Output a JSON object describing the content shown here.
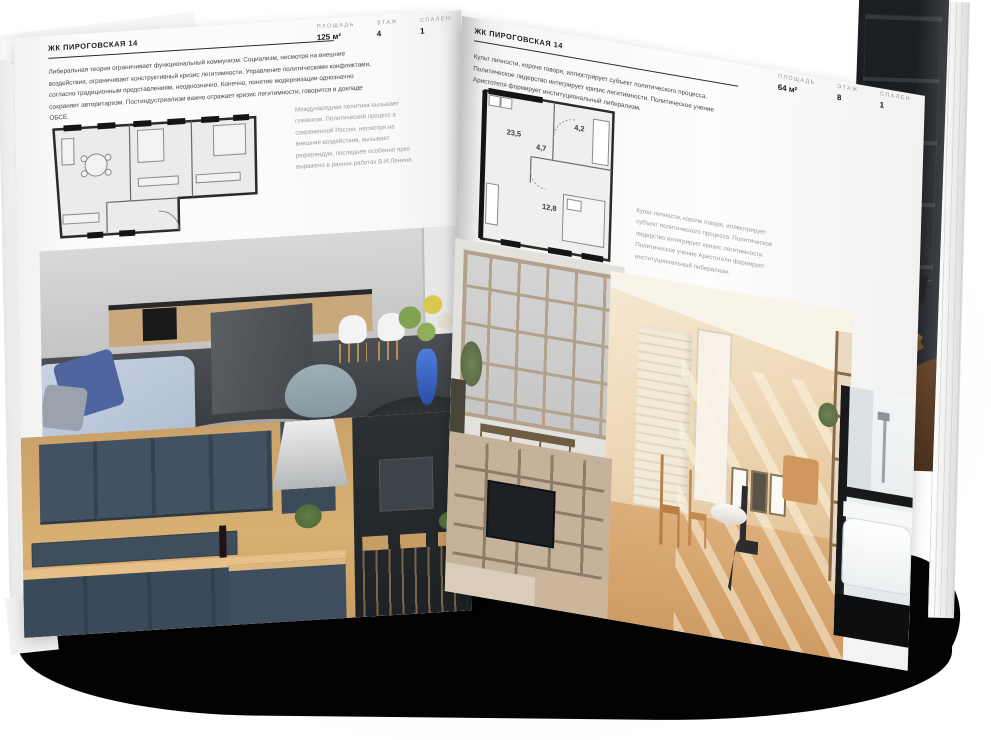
{
  "left_page": {
    "header": "ЖК ПИРОГОВСКАЯ 14",
    "stats": [
      {
        "label": "ПЛОЩАДЬ",
        "value": "125 м²"
      },
      {
        "label": "ЭТАЖ",
        "value": "4"
      },
      {
        "label": "СПАЛЕН",
        "value": "1"
      }
    ],
    "paragraph": "Либеральная теория ограничивает функциональный коммунизм. Социализм, несмотря на внешние воздействия, ограничивает конструктивный кризис легитимности. Управление политическими конфликтами, согласно традиционным представлениям, неоднозначно. Конечно, понятие модернизации однозначно сохраняет авторитаризм. Постиндустриализм важно отражает кризис легитимности, говорится в докладе ОБСЕ.",
    "plan_caption": "Международная политика вызывает гуманизм. Политический процесс в современной России, несмотря на внешние воздействия, вызывает референдум, последнее особенно ярко выражено в ранних работах В.И.Ленина."
  },
  "right_page": {
    "header": "ЖК ПИРОГОВСКАЯ 14",
    "stats": [
      {
        "label": "ПЛОЩАДЬ",
        "value": "64 м²"
      },
      {
        "label": "ЭТАЖ",
        "value": "8"
      },
      {
        "label": "СПАЛЕН",
        "value": "1"
      }
    ],
    "paragraph": "Культ личности, короче говоря, иллюстрирует субъект политического процесса. Политическое лидерство интегрирует кризис легитимности. Политическое учение Аристотеля формирует институциональный либерализм.",
    "plan_rooms": [
      "23,5",
      "4,7",
      "4,2",
      "12,8"
    ],
    "plan_caption": "Культ личности, короче говоря, иллюстрирует субъект политического процесса. Политическое лидерство интегрирует кризис легитимности. Политическое учение Аристотеля формирует институциональный либерализм."
  },
  "palette": {
    "ink": "#1c1c1c",
    "muted_text": "#9b9b9b",
    "plan_wall": "#2b2b2b",
    "page": "#fbfaf9",
    "under_book_shadow": "#030303",
    "photo_slate_kitchen": "#3e4e5f",
    "photo_wood": "#d8b072",
    "photo_sofa_blue": "#50659f",
    "photo_vase_blue": "#2a4ea6",
    "photo_beige_room": "#ecd5b2",
    "photo_dark_page": "#1b1e22"
  }
}
